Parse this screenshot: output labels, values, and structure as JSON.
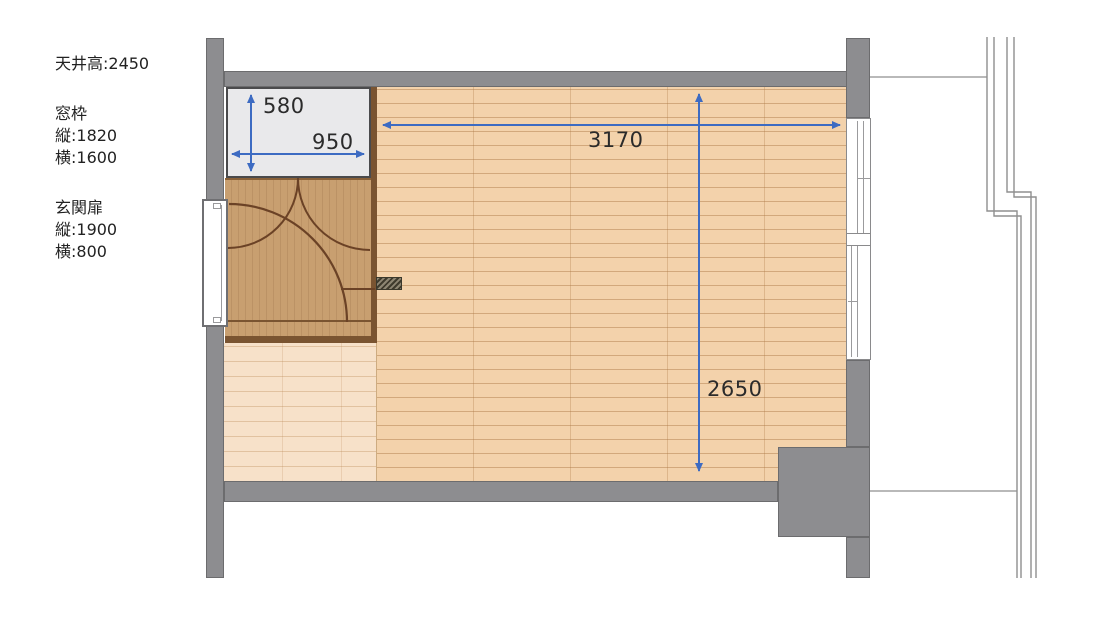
{
  "notes": {
    "ceiling": "天井高:2450",
    "window_title": "窓枠",
    "window_v": "縦:1820",
    "window_h": "横:1600",
    "door_title": "玄関扉",
    "door_v": "縦:1900",
    "door_h": "横:800"
  },
  "dims": {
    "closet_depth": "580",
    "closet_width": "950",
    "room_width": "3170",
    "room_depth": "2650"
  },
  "colors": {
    "wall_gray": "#8d8d90",
    "floor_main": "#f3d2ab",
    "entry_wood": "#c89f70",
    "wood_border": "#7a5431",
    "dimension_blue": "#3d6bc2",
    "text": "#2d2d2d"
  }
}
